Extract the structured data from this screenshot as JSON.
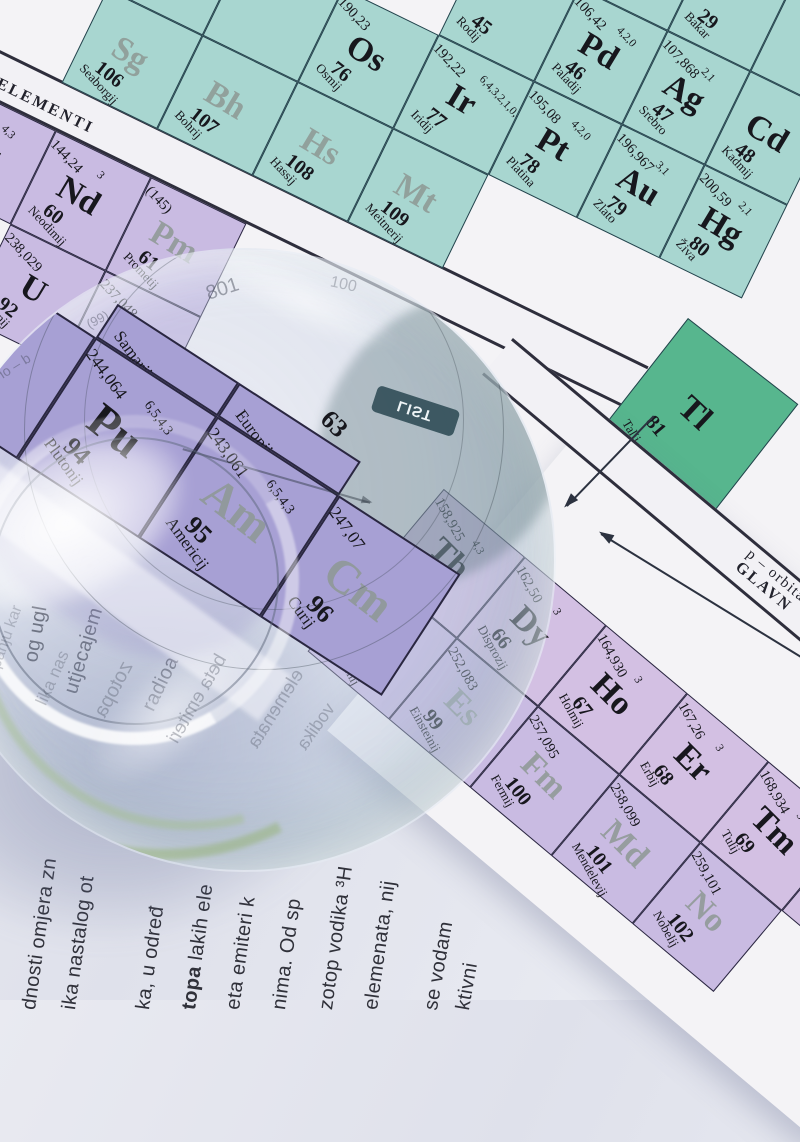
{
  "colors": {
    "teal": "#a8d6d0",
    "tealLine": "#24424c",
    "green": "#57b68e",
    "lav": "#c9bbe2",
    "lavPink": "#d3c0e3",
    "lavLine": "#2a2740",
    "lensLav": "#a7a0d4",
    "paper": "#f4f3f6",
    "ink": "#17171d",
    "ghostSymbol": "#8e9894"
  },
  "sheet": {
    "strip_d_line1": "d – orbitale",
    "strip_d_line2": "PRIJELAZNI ELEMENTI",
    "strip_p_line1": "p – orbitale",
    "strip_p_line2": "GLAVN"
  },
  "d_block": {
    "cells": [
      {
        "x": -212,
        "y": 104,
        "w": 106,
        "h": 104,
        "color": "teal",
        "line": "tealLine"
      },
      {
        "x": -106,
        "y": 104,
        "w": 106,
        "h": 104,
        "color": "teal",
        "line": "tealLine"
      },
      {
        "x": 0,
        "y": 104,
        "w": 106,
        "h": 104,
        "color": "teal",
        "line": "tealLine",
        "mass": "190,23",
        "sym": "Os",
        "num": "76",
        "name": "Osmij"
      },
      {
        "x": 106,
        "y": 104,
        "w": 106,
        "h": 104,
        "color": "teal",
        "line": "tealLine",
        "mass": "192,22",
        "ox": "6,4,3,2,1,0,-1",
        "sym": "Ir",
        "num": "77",
        "name": "Iridij"
      },
      {
        "x": 212,
        "y": 104,
        "w": 98,
        "h": 104,
        "color": "teal",
        "line": "tealLine",
        "mass": "195,08",
        "ox": "4,2,0",
        "sym": "Pt",
        "num": "78",
        "name": "Platina"
      },
      {
        "x": 310,
        "y": 104,
        "w": 92,
        "h": 104,
        "color": "teal",
        "line": "tealLine",
        "mass": "196,967",
        "ox": "3,1",
        "sym": "Au",
        "num": "79",
        "name": "Zlato"
      },
      {
        "x": 402,
        "y": 104,
        "w": 92,
        "h": 104,
        "color": "teal",
        "line": "tealLine",
        "mass": "200,59",
        "ox": "2,1",
        "sym": "Hg",
        "num": "80",
        "name": "Živa"
      },
      {
        "x": -212,
        "y": 208,
        "w": 106,
        "h": 104,
        "color": "teal",
        "line": "tealLine",
        "sym": "Sg",
        "num": "106",
        "name": "Seaborgij",
        "ghost": 1
      },
      {
        "x": -106,
        "y": 208,
        "w": 106,
        "h": 104,
        "color": "teal",
        "line": "tealLine",
        "sym": "Bh",
        "num": "107",
        "name": "Bohrij",
        "ghost": 1
      },
      {
        "x": 0,
        "y": 208,
        "w": 106,
        "h": 104,
        "color": "teal",
        "line": "tealLine",
        "sym": "Hs",
        "num": "108",
        "name": "Hassij",
        "ghost": 1
      },
      {
        "x": 106,
        "y": 208,
        "w": 106,
        "h": 104,
        "color": "teal",
        "line": "tealLine",
        "sym": "Mt",
        "num": "109",
        "name": "Meitnerij",
        "ghost": 1
      },
      {
        "x": 106,
        "y": 0,
        "w": 106,
        "h": 104,
        "color": "teal",
        "line": "tealLine",
        "num": "45",
        "name": "Rodij"
      },
      {
        "x": 212,
        "y": 0,
        "w": 98,
        "h": 104,
        "color": "teal",
        "line": "tealLine",
        "mass": "106,42",
        "ox": "4,2,0",
        "sym": "Pd",
        "num": "46",
        "name": "Paladij"
      },
      {
        "x": 310,
        "y": 0,
        "w": 92,
        "h": 104,
        "color": "teal",
        "line": "tealLine",
        "mass": "107,868",
        "ox": "2,1",
        "sym": "Ag",
        "num": "47",
        "name": "Srebro"
      },
      {
        "x": 402,
        "y": 0,
        "w": 92,
        "h": 104,
        "color": "teal",
        "line": "tealLine",
        "sym": "Cd",
        "num": "48",
        "name": "Kadmij"
      },
      {
        "x": 212,
        "y": -104,
        "w": 98,
        "h": 104,
        "color": "teal",
        "line": "tealLine"
      },
      {
        "x": 310,
        "y": -104,
        "w": 92,
        "h": 104,
        "color": "teal",
        "line": "tealLine",
        "num": "29",
        "name": "Bakar"
      },
      {
        "x": 402,
        "y": -104,
        "w": 92,
        "h": 104,
        "color": "teal",
        "line": "tealLine"
      }
    ]
  },
  "f_block_left": {
    "cells": [
      {
        "x": -302,
        "y": 358,
        "w": 106,
        "h": 104,
        "color": "lav",
        "line": "lavLine",
        "mass": "140,908",
        "ox": "4,3",
        "sym": "Pr",
        "num": "59",
        "name": "Prazeodimij"
      },
      {
        "x": -196,
        "y": 358,
        "w": 106,
        "h": 104,
        "color": "lav",
        "line": "lavLine",
        "mass": "144,24",
        "ox": "3",
        "sym": "Nd",
        "num": "60",
        "name": "Neodimij"
      },
      {
        "x": -90,
        "y": 358,
        "w": 106,
        "h": 104,
        "color": "lav",
        "line": "lavLine",
        "mass": "(145)",
        "sym": "Pm",
        "num": "61",
        "name": "Prometij",
        "ghost": 1
      },
      {
        "x": -196,
        "y": 462,
        "w": 106,
        "h": 104,
        "color": "lav",
        "line": "lavLine",
        "mass": "238,029",
        "sym": "U",
        "num": "92",
        "name": "Uranij"
      },
      {
        "x": -90,
        "y": 462,
        "w": 106,
        "h": 104,
        "color": "lav",
        "line": "lavLine",
        "mass": "237,048",
        "sym": "Np",
        "num": "93",
        "name": "Neptunij",
        "ghost": 1
      }
    ]
  },
  "p_block": {
    "cells": [
      {
        "x": 0,
        "y": 0,
        "w": 140,
        "h": 150,
        "color": "green",
        "line": "tealLine",
        "sym": "Tl",
        "num": "81",
        "name": "Talij"
      }
    ]
  },
  "f_block_right": {
    "cells": [
      {
        "x": -106,
        "y": 0,
        "w": 106,
        "h": 106,
        "color": "lavPink",
        "line": "lavLine",
        "mass": "158,925",
        "ox": "4,3",
        "sym": "Tb",
        "num": "65",
        "name": "Terbij"
      },
      {
        "x": 0,
        "y": 0,
        "w": 106,
        "h": 106,
        "color": "lavPink",
        "line": "lavLine",
        "mass": "162,50",
        "ox": "3",
        "sym": "Dy",
        "num": "66",
        "name": "Disprozij"
      },
      {
        "x": 106,
        "y": 0,
        "w": 106,
        "h": 106,
        "color": "lavPink",
        "line": "lavLine",
        "mass": "164,930",
        "ox": "3",
        "sym": "Ho",
        "num": "67",
        "name": "Holmij"
      },
      {
        "x": 212,
        "y": 0,
        "w": 106,
        "h": 106,
        "color": "lavPink",
        "line": "lavLine",
        "mass": "167,26",
        "ox": "3",
        "sym": "Er",
        "num": "68",
        "name": "Erbij"
      },
      {
        "x": 318,
        "y": 0,
        "w": 106,
        "h": 106,
        "color": "lavPink",
        "line": "lavLine",
        "mass": "168,934",
        "ox": "3",
        "sym": "Tm",
        "num": "69",
        "name": "Tulij"
      },
      {
        "x": 424,
        "y": 0,
        "w": 106,
        "h": 106,
        "color": "lavPink",
        "line": "lavLine",
        "mass": "173,04",
        "sym": "Yb",
        "num": "70",
        "name": "Iterbij"
      },
      {
        "x": -106,
        "y": 106,
        "w": 106,
        "h": 106,
        "color": "lav",
        "line": "lavLine",
        "mass": "251,080",
        "sym": "Cf",
        "num": "98",
        "name": "Kalifornij",
        "ghost": 1
      },
      {
        "x": 0,
        "y": 106,
        "w": 106,
        "h": 106,
        "color": "lav",
        "line": "lavLine",
        "mass": "252,083",
        "sym": "Es",
        "num": "99",
        "name": "Einsteinij",
        "ghost": 1
      },
      {
        "x": 106,
        "y": 106,
        "w": 106,
        "h": 106,
        "color": "lav",
        "line": "lavLine",
        "mass": "257,095",
        "sym": "Fm",
        "num": "100",
        "name": "Fermij",
        "ghost": 1
      },
      {
        "x": 212,
        "y": 106,
        "w": 106,
        "h": 106,
        "color": "lav",
        "line": "lavLine",
        "mass": "258,099",
        "sym": "Md",
        "num": "101",
        "name": "Mendelevij",
        "ghost": 1
      },
      {
        "x": 318,
        "y": 106,
        "w": 106,
        "h": 106,
        "color": "lav",
        "line": "lavLine",
        "mass": "259,101",
        "sym": "No",
        "num": "102",
        "name": "Nobelij",
        "ghost": 1
      }
    ]
  },
  "lens": {
    "badge": "LIST",
    "cells": [
      {
        "x": -217,
        "y": -72,
        "w": 145,
        "h": 145,
        "color": "lensLav",
        "line": "lavLine"
      },
      {
        "x": -72,
        "y": -112,
        "w": 145,
        "h": 40,
        "color": "lensLav",
        "line": "lavLine",
        "name": "Samarij",
        "partial": 1
      },
      {
        "x": 73,
        "y": -112,
        "w": 145,
        "h": 40,
        "color": "lensLav",
        "line": "lavLine",
        "num": "63",
        "name": "Europij",
        "partial": 1
      },
      {
        "x": -72,
        "y": -72,
        "w": 145,
        "h": 145,
        "color": "lensLav",
        "line": "lavLine",
        "mass": "244,064",
        "ox": "6,5,4,3",
        "sym": "Pu",
        "num": "94",
        "name": "Plutonij"
      },
      {
        "x": 73,
        "y": -72,
        "w": 145,
        "h": 145,
        "color": "lensLav",
        "line": "lavLine",
        "mass": "243,061",
        "ox": "6,5,4,3",
        "sym": "Am",
        "num": "95",
        "name": "Americij",
        "ghost": 1
      },
      {
        "x": 218,
        "y": -72,
        "w": 145,
        "h": 145,
        "color": "lensLav",
        "line": "lavLine",
        "mass": "247,07",
        "sym": "Cm",
        "num": "96",
        "name": "Curij",
        "ghost": 1
      }
    ],
    "ghosts": [
      {
        "x": 272,
        "y": 28,
        "rot": -18,
        "text": "801",
        "size": 20,
        "op": 0.45
      },
      {
        "x": 152,
        "y": 62,
        "rot": -28,
        "text": "(99)",
        "size": 13,
        "op": 0.4
      },
      {
        "x": 62,
        "y": 108,
        "rot": -32,
        "text": "d – or",
        "size": 14,
        "op": 0.4,
        "mirror": 1
      },
      {
        "x": 396,
        "y": 26,
        "rot": 12,
        "text": "100",
        "size": 16,
        "op": 0.3
      },
      {
        "x": 150,
        "y": 428,
        "rot": -62,
        "text": "zotopa",
        "size": 20,
        "op": 0.3,
        "mirror": 1
      },
      {
        "x": 214,
        "y": 438,
        "rot": -60,
        "text": "beta emiteri",
        "size": 19,
        "op": 0.32,
        "mirror": 1
      },
      {
        "x": 298,
        "y": 448,
        "rot": -58,
        "text": "elemenata",
        "size": 19,
        "op": 0.3,
        "mirror": 1
      },
      {
        "x": 90,
        "y": 418,
        "rot": -66,
        "text": "lika nas",
        "size": 17,
        "op": 0.28
      },
      {
        "x": 40,
        "y": 378,
        "rot": -70,
        "text": "panju kar",
        "size": 16,
        "op": 0.25
      },
      {
        "x": 356,
        "y": 466,
        "rot": -55,
        "text": "vodika",
        "size": 18,
        "op": 0.3,
        "mirror": 1
      },
      {
        "x": 20,
        "y": 336,
        "rot": -74,
        "text": "anjenice",
        "size": 15,
        "op": 0.25
      }
    ]
  },
  "book": {
    "columns": [
      {
        "x": 18,
        "y": 1008,
        "rot": -82,
        "t": "dnosti omjera zn"
      },
      {
        "x": 58,
        "y": 1008,
        "rot": -82,
        "t": "ika nastalog ot"
      },
      {
        "x": 132,
        "y": 1008,
        "rot": -82,
        "t": "ka,  u  određ"
      },
      {
        "x": 178,
        "y": 1008,
        "rot": -82,
        "b": "topa",
        "t": " lakih ele"
      },
      {
        "x": 222,
        "y": 1008,
        "rot": -82,
        "t": "eta emiteri k"
      },
      {
        "x": 268,
        "y": 1008,
        "rot": -82,
        "t": "nima. Od sp"
      },
      {
        "x": 315,
        "y": 1008,
        "rot": -82,
        "t": "zotop vodika ³H"
      },
      {
        "x": 360,
        "y": 1008,
        "rot": -82,
        "t": "elemenata,  nij"
      },
      {
        "x": 420,
        "y": 1008,
        "rot": -80,
        "t": "se vodam"
      },
      {
        "x": 452,
        "y": 1008,
        "rot": -80,
        "t": "ktivni"
      },
      {
        "x": 20,
        "y": 660,
        "rot": -80,
        "t": "og ugl"
      },
      {
        "x": 60,
        "y": 690,
        "rot": -73,
        "t": "utjecajem"
      },
      {
        "x": 138,
        "y": 705,
        "rot": -64,
        "t": "radioa"
      }
    ]
  }
}
